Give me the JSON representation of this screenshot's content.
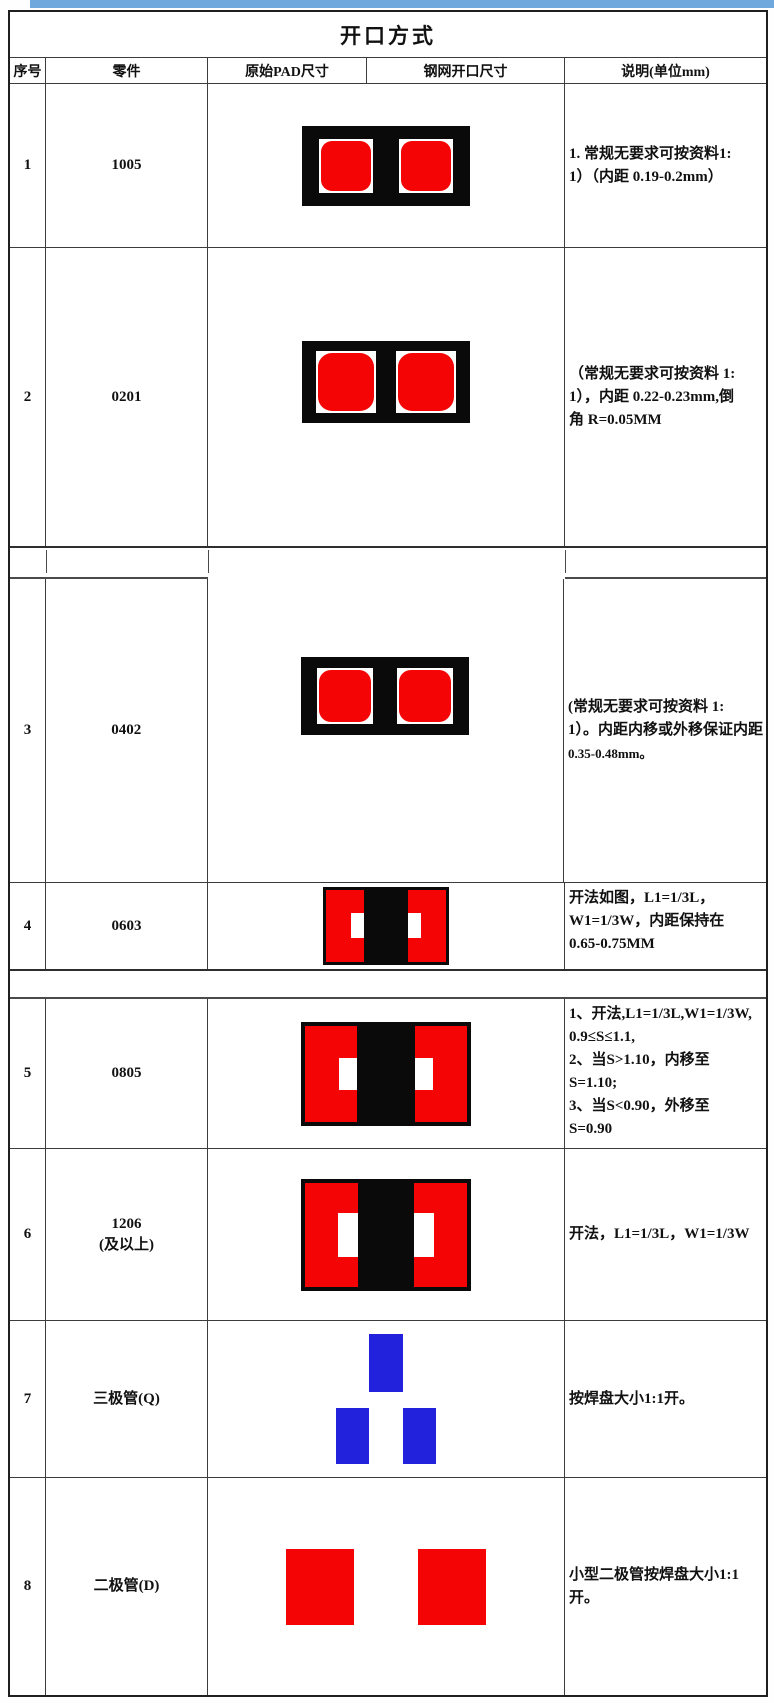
{
  "title": "开口方式",
  "columns": [
    "序号",
    "零件",
    "原始PAD尺寸",
    "钢网开口尺寸",
    "说明(单位mm)"
  ],
  "rows": [
    {
      "no": "1",
      "part": "1005",
      "desc_lines": [
        "1.  常规无要求可按资料1:",
        "1）（内距 0.19-0.2mm）"
      ],
      "graphic": "two-rounded-red-pads-on-black"
    },
    {
      "no": "2",
      "part": "0201",
      "desc_lines": [
        "（常规无要求可按资料 1:",
        "1），内距 0.22-0.23mm,倒",
        "角 R=0.05MM"
      ],
      "graphic": "two-rounded-red-pads-on-black"
    },
    {
      "no": "3",
      "part": "0402",
      "desc_lines": [
        "(常规无要求可按资料 1:",
        "1）。内距内移或外移保证内距",
        "0.35-0.48mm。"
      ],
      "graphic": "two-rounded-red-pads-on-black"
    },
    {
      "no": "4",
      "part": "0603",
      "desc_lines": [
        "开法如图，L1=1/3L，",
        "W1=1/3W，内距保持在",
        "0.65-0.75MM"
      ],
      "graphic": "red-block-black-band-white-notches"
    },
    {
      "no": "5",
      "part": "0805",
      "desc_lines": [
        "1、开法,L1=1/3L,W1=1/3W,",
        "0.9≤S≤1.1,",
        "2、当S>1.10，内移至",
        "S=1.10;",
        "3、当S<0.90，外移至",
        "S=0.90"
      ],
      "graphic": "red-block-black-band-white-notches"
    },
    {
      "no": "6",
      "part": "1206",
      "part2": "(及以上)",
      "desc_lines": [
        "开法，L1=1/3L，W1=1/3W"
      ],
      "graphic": "red-block-black-band-white-notches"
    },
    {
      "no": "7",
      "part": "三极管(Q)",
      "desc_lines": [
        "按焊盘大小1:1开。"
      ],
      "graphic": "three-blue-pads"
    },
    {
      "no": "8",
      "part": "二极管(D)",
      "desc_lines": [
        "小型二极管按焊盘大小1:1",
        "开。"
      ],
      "graphic": "two-red-pads"
    }
  ],
  "colors": {
    "pad_red": "#f40404",
    "pad_black": "#0a0a0a",
    "pad_white": "#ffffff",
    "pad_blue": "#2222dd",
    "top_bar_blue": "#6fa8dc",
    "border_dark": "#1f1f1f"
  }
}
